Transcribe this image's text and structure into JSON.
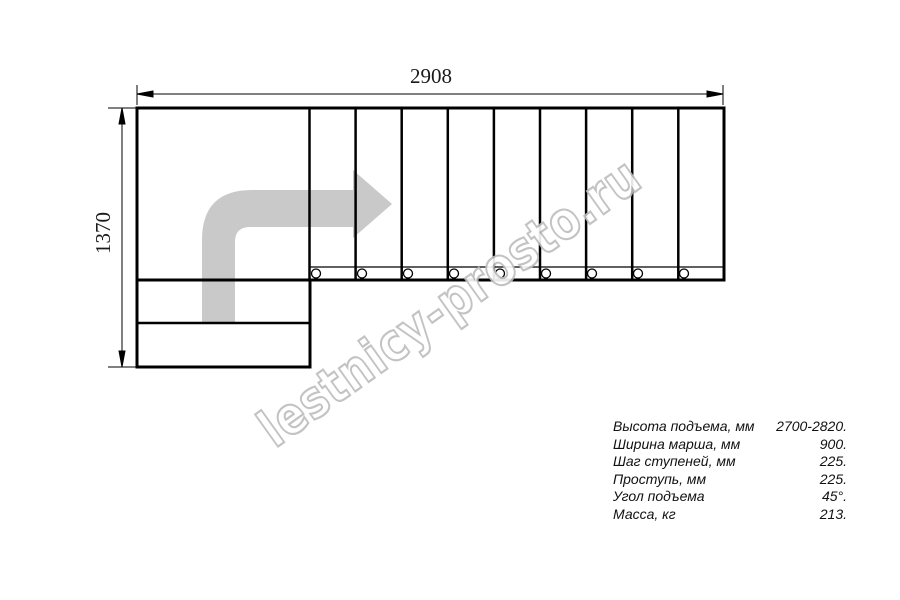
{
  "drawing": {
    "type": "staircase-plan-top-view",
    "dimensions": {
      "width_mm": "2908",
      "height_mm": "1370"
    }
  },
  "watermark": {
    "text": "lestnicy-prosto.ru"
  },
  "specs": {
    "rows": [
      {
        "label": "Высота подъема, мм",
        "value": "2700-2820."
      },
      {
        "label": "Ширина марша, мм",
        "value": "900."
      },
      {
        "label": "Шаг ступеней, мм",
        "value": "225."
      },
      {
        "label": "Проступь, мм",
        "value": "225."
      },
      {
        "label": "Угол подъема",
        "value": "45°."
      },
      {
        "label": "Масса, кг",
        "value": "213."
      }
    ]
  },
  "colors": {
    "line": "#000000",
    "arrow_fill": "#c9c9c9",
    "watermark_outline": "#bdbdbd",
    "background": "#ffffff"
  }
}
